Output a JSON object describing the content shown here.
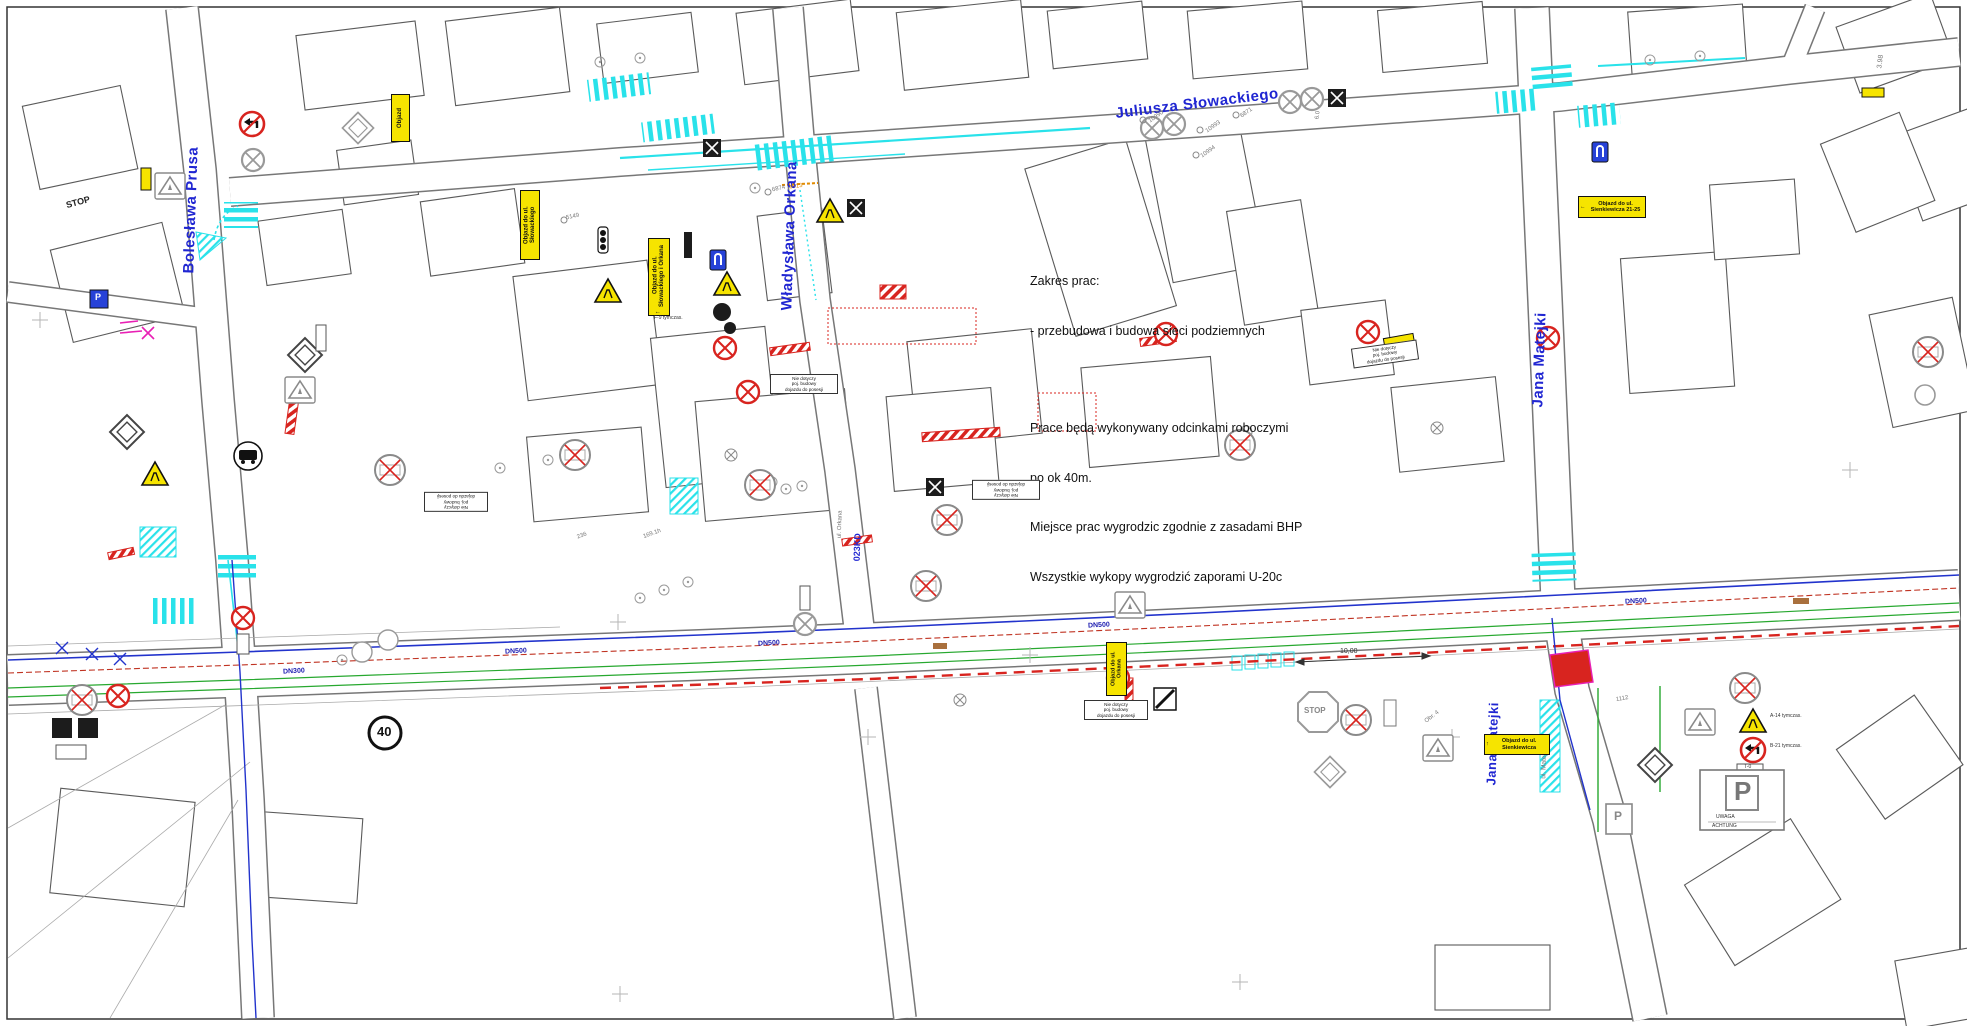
{
  "colors": {
    "cyan": "#29e2ea",
    "street_blue": "#2026d2",
    "utility_blue": "#2233cc",
    "utility_green": "#27a82f",
    "red": "#d8241f",
    "magenta": "#e820b4",
    "yellow": "#f6e400",
    "grey": "#6b6b6b",
    "building": "#5a5a5a",
    "orange": "#e08a00",
    "tan": "#a9703d"
  },
  "streets": {
    "slowackiego": "Juliusza Słowackiego",
    "prusa": "Bolesława Prusa",
    "orkana": "Władysława Orkana",
    "matejki_top": "Jana Matejki",
    "matejki_bottom": "Jana Matejki",
    "ul_matejki": "ul. Matejki"
  },
  "notes": {
    "title": "Zakres prac:",
    "line1": "- przebudowa i budowa sieci podziemnych",
    "line2": "Prace będą wykonywany odcinkami roboczymi",
    "line3": "po ok 40m.",
    "line4": "Miejsce prac wygrodzic zgodnie z zasadami BHP",
    "line5": "Wszystkie wykopy wygrodzić zaporami U-20c"
  },
  "detours": {
    "d1": "Objazd do ul. Słowackiego i Orkana",
    "d1_code": "F-9 tymczas.",
    "d2": "Objazd do ul. Słowackiego",
    "d3": "Objazd",
    "d4": "Objazd do ul. Sienkiewicza 21-25",
    "d5": "Objazd do ul. Orkana",
    "d6": "Objazd do ul. Sienkiewicza"
  },
  "reg_sign": {
    "l1": "Nie dotyczy",
    "l2": "poj. budowy",
    "l3": "dojazdu do posesji"
  },
  "signs": {
    "stop": "STOP",
    "speed": "40",
    "parking": "P",
    "uwaga": "UWAGA",
    "achtung": "ACHTUNG",
    "a14": "A-14",
    "b21": "B-21",
    "t0": "T-0",
    "tymczas": "tymczas."
  },
  "utilities": {
    "dn500": "DN500",
    "dn300": "DN300",
    "kd": "023KD",
    "orkana_ref": "ul. Orkana",
    "p13": "P-13"
  },
  "survey": {
    "s1": "10990",
    "s2": "10993",
    "s3": "10994",
    "s4": "6871",
    "s5": "6874",
    "s6": "5149",
    "s7": "3.98",
    "s8": "6.0",
    "s9": "1112",
    "obr": "Obr. 4",
    "dim": "10,00",
    "n1": "236",
    "n2": "169.1h"
  },
  "icons": {
    "arrow_left": "←",
    "arrow_up": "↑"
  }
}
